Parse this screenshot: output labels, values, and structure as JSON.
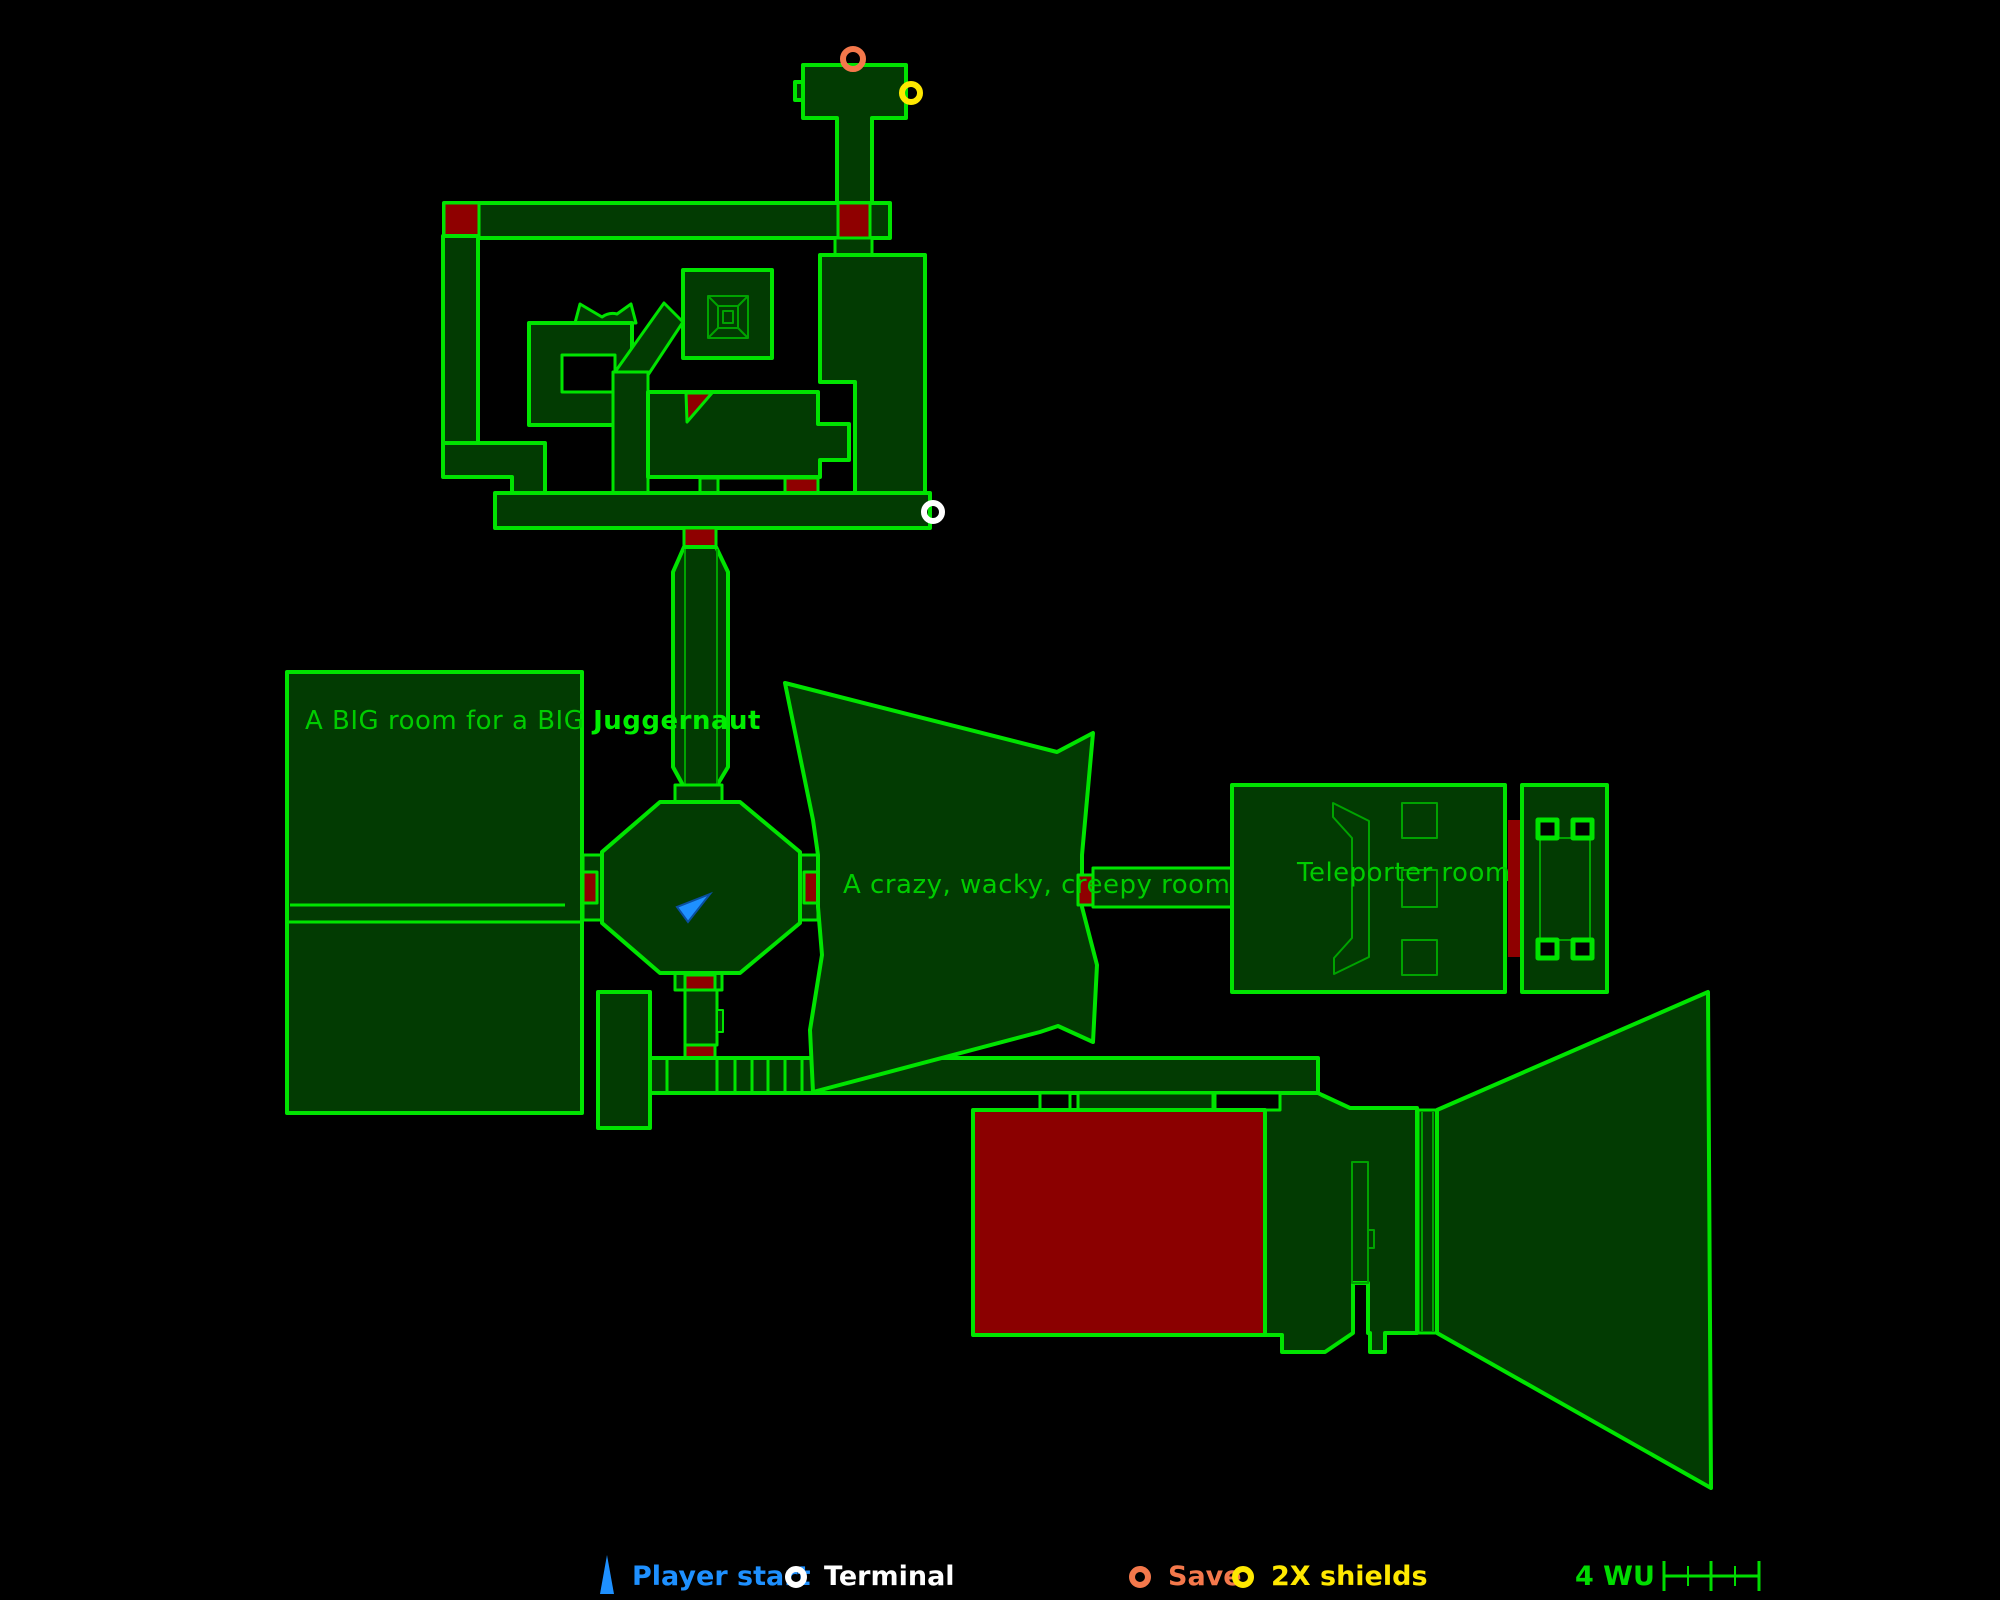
{
  "map": {
    "rooms": {
      "big_room": {
        "label_regular": "A BIG room for a BIG ",
        "label_bold": "Juggernaut"
      },
      "crazy_room": {
        "label": "A crazy, wacky, creepy room"
      },
      "teleporter_room": {
        "label": "Teleporter room"
      }
    },
    "icons": [
      {
        "name": "save-icon",
        "shape": "orange-ring"
      },
      {
        "name": "2x-shields-icon",
        "shape": "yellow-ring"
      },
      {
        "name": "terminal-icon",
        "shape": "white-ring"
      },
      {
        "name": "player-start-icon",
        "shape": "blue-arrow"
      }
    ]
  },
  "legend": {
    "items": [
      {
        "label": "Player start",
        "color": "#1E90FF",
        "icon": "player-start-arrow"
      },
      {
        "label": "Terminal",
        "color": "#FFFFFF",
        "icon": "terminal-ring"
      },
      {
        "label": "Save",
        "color": "#F4784B",
        "icon": "save-ring"
      },
      {
        "label": "2X shields",
        "color": "#FFE800",
        "icon": "shields-ring"
      }
    ],
    "scale": {
      "label": "4 WU"
    }
  },
  "colors": {
    "background": "#000000",
    "wall_outline": "#00E400",
    "detail_line": "#00A300",
    "room_fill": "#023B02",
    "door_red": "#8F0000",
    "red_room_fill": "#8B0000",
    "label_green": "#00CC00",
    "player_blue": "#1E90FF",
    "terminal_white": "#FFFFFF",
    "save_orange": "#F4784B",
    "shields_yellow": "#FFE800"
  }
}
